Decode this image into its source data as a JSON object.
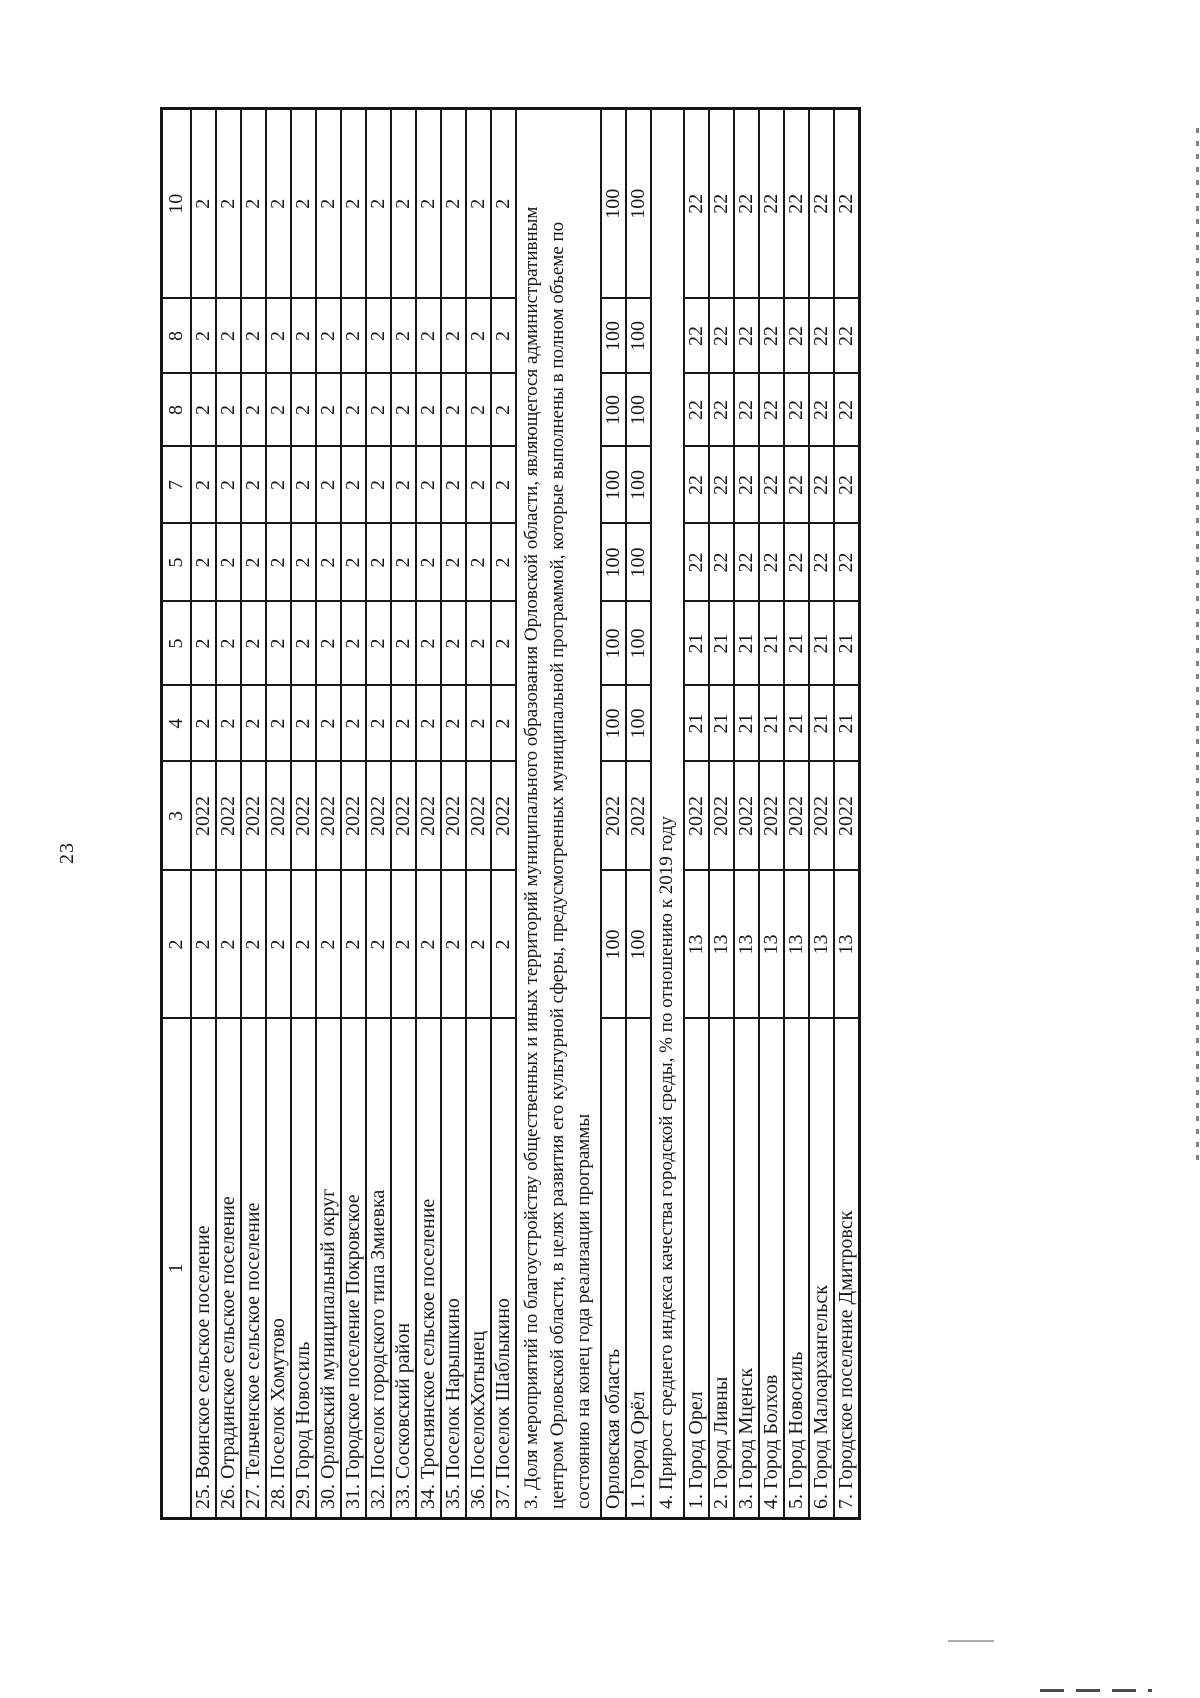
{
  "page": {
    "number": "23"
  },
  "table": {
    "header": [
      "1",
      "2",
      "3",
      "4",
      "5",
      "5",
      "7",
      "8",
      "8",
      "10"
    ],
    "rows": [
      {
        "kind": "data",
        "cells": [
          "25. Воинское сельское поселение",
          "2",
          "2022",
          "2",
          "2",
          "2",
          "2",
          "2",
          "2",
          "2"
        ]
      },
      {
        "kind": "data",
        "cells": [
          "26. Отрадинское сельское поселение",
          "2",
          "2022",
          "2",
          "2",
          "2",
          "2",
          "2",
          "2",
          "2"
        ]
      },
      {
        "kind": "data",
        "cells": [
          "27. Тельченское сельское поселение",
          "2",
          "2022",
          "2",
          "2",
          "2",
          "2",
          "2",
          "2",
          "2"
        ]
      },
      {
        "kind": "data",
        "cells": [
          "28. Поселок Хомутово",
          "2",
          "2022",
          "2",
          "2",
          "2",
          "2",
          "2",
          "2",
          "2"
        ]
      },
      {
        "kind": "data",
        "cells": [
          "29. Город Новосиль",
          "2",
          "2022",
          "2",
          "2",
          "2",
          "2",
          "2",
          "2",
          "2"
        ]
      },
      {
        "kind": "data",
        "cells": [
          "30. Орловский муниципальный округ",
          "2",
          "2022",
          "2",
          "2",
          "2",
          "2",
          "2",
          "2",
          "2"
        ]
      },
      {
        "kind": "data",
        "cells": [
          "31. Городское поселение Покровское",
          "2",
          "2022",
          "2",
          "2",
          "2",
          "2",
          "2",
          "2",
          "2"
        ]
      },
      {
        "kind": "data",
        "cells": [
          "32. Поселок городского типа Змиевка",
          "2",
          "2022",
          "2",
          "2",
          "2",
          "2",
          "2",
          "2",
          "2"
        ]
      },
      {
        "kind": "data",
        "cells": [
          "33. Сосковский район",
          "2",
          "2022",
          "2",
          "2",
          "2",
          "2",
          "2",
          "2",
          "2"
        ]
      },
      {
        "kind": "data",
        "cells": [
          "34. Троснянское сельское поселение",
          "2",
          "2022",
          "2",
          "2",
          "2",
          "2",
          "2",
          "2",
          "2"
        ]
      },
      {
        "kind": "data",
        "cells": [
          "35. Поселок Нарышкино",
          "2",
          "2022",
          "2",
          "2",
          "2",
          "2",
          "2",
          "2",
          "2"
        ]
      },
      {
        "kind": "data",
        "cells": [
          "36. ПоселокХотынец",
          "2",
          "2022",
          "2",
          "2",
          "2",
          "2",
          "2",
          "2",
          "2"
        ]
      },
      {
        "kind": "data",
        "cells": [
          "37. Поселок Шаблыкино",
          "2",
          "2022",
          "2",
          "2",
          "2",
          "2",
          "2",
          "2",
          "2"
        ]
      },
      {
        "kind": "note",
        "lines": [
          "3. Доля мероприятий по благоустройству общественных и иных территорий муниципального образования Орловской области, являющегося административным",
          "центром Орловской области, в целях развития его культурной сферы, предусмотренных муниципальной программой, которые выполнены в полном объеме по",
          "состоянию на конец года реализации программы"
        ]
      },
      {
        "kind": "data",
        "cells": [
          "Орловская область",
          "100",
          "2022",
          "100",
          "100",
          "100",
          "100",
          "100",
          "100",
          "100"
        ]
      },
      {
        "kind": "data",
        "cells": [
          "1. Город Орёл",
          "100",
          "2022",
          "100",
          "100",
          "100",
          "100",
          "100",
          "100",
          "100"
        ]
      },
      {
        "kind": "note",
        "lines": [
          "4. Прирост среднего индекса качества городской среды, % по отношению к 2019 году"
        ]
      },
      {
        "kind": "data",
        "cells": [
          "1. Город Орел",
          "13",
          "2022",
          "21",
          "21",
          "22",
          "22",
          "22",
          "22",
          "22"
        ]
      },
      {
        "kind": "data",
        "cells": [
          "2. Город Ливны",
          "13",
          "2022",
          "21",
          "21",
          "22",
          "22",
          "22",
          "22",
          "22"
        ]
      },
      {
        "kind": "data",
        "cells": [
          "3. Город Мценск",
          "13",
          "2022",
          "21",
          "21",
          "22",
          "22",
          "22",
          "22",
          "22"
        ]
      },
      {
        "kind": "data",
        "cells": [
          "4. Город Болхов",
          "13",
          "2022",
          "21",
          "21",
          "22",
          "22",
          "22",
          "22",
          "22"
        ]
      },
      {
        "kind": "data",
        "cells": [
          "5. Город Новосиль",
          "13",
          "2022",
          "21",
          "21",
          "22",
          "22",
          "22",
          "22",
          "22"
        ]
      },
      {
        "kind": "data",
        "cells": [
          "6. Город Малоархангельск",
          "13",
          "2022",
          "21",
          "21",
          "22",
          "22",
          "22",
          "22",
          "22"
        ]
      },
      {
        "kind": "data",
        "cells": [
          "7. Городское поселение Дмитровск",
          "13",
          "2022",
          "21",
          "21",
          "22",
          "22",
          "22",
          "22",
          "22"
        ]
      }
    ]
  }
}
